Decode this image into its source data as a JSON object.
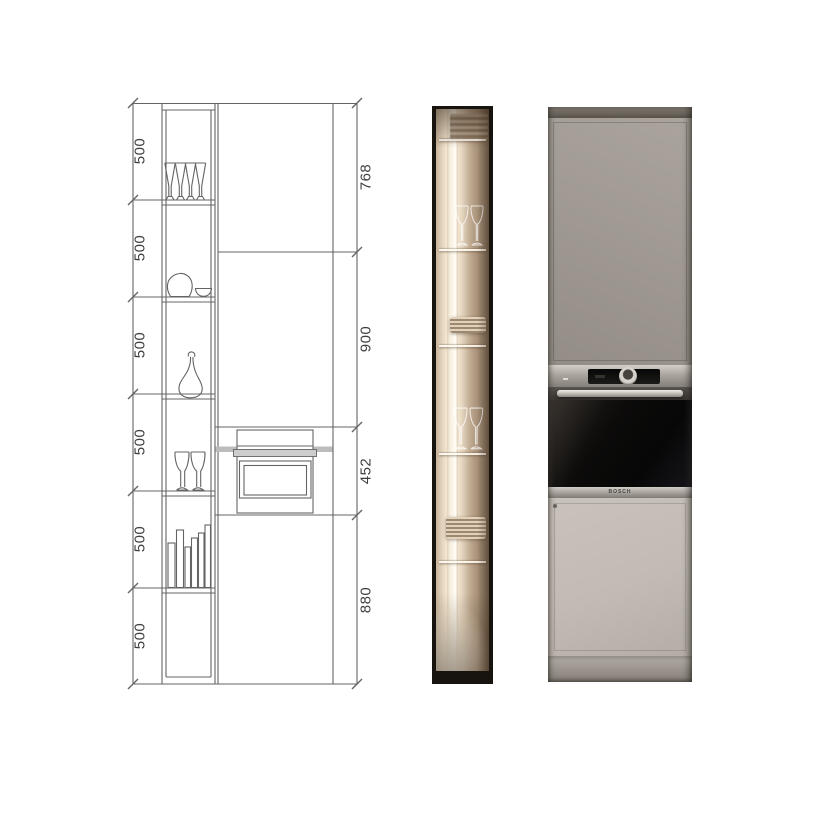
{
  "drawing": {
    "left_dims": [
      "500",
      "500",
      "500",
      "500",
      "500",
      "500"
    ],
    "right_dims": [
      "768",
      "900",
      "452",
      "880"
    ],
    "line_color": "#4f4f4f",
    "shelf_item_icons": [
      "champagne-flutes-icon",
      "bowl-and-dish-icon",
      "decanter-icon",
      "wine-glasses-icon",
      "books-icon"
    ],
    "oven_icon": "built-in-oven-outline"
  },
  "display_photo": {
    "frame_color": "#17130e",
    "led_color": "#fffdf6",
    "interior_warm_color": "#d2bea6"
  },
  "oven_photo": {
    "brand": "BOSCH",
    "upper_door_color": "#a19a94",
    "lower_door_color": "#c2bbb4",
    "oven_door_color": "#0c0b0a",
    "panel_color": "#aaa59f"
  }
}
